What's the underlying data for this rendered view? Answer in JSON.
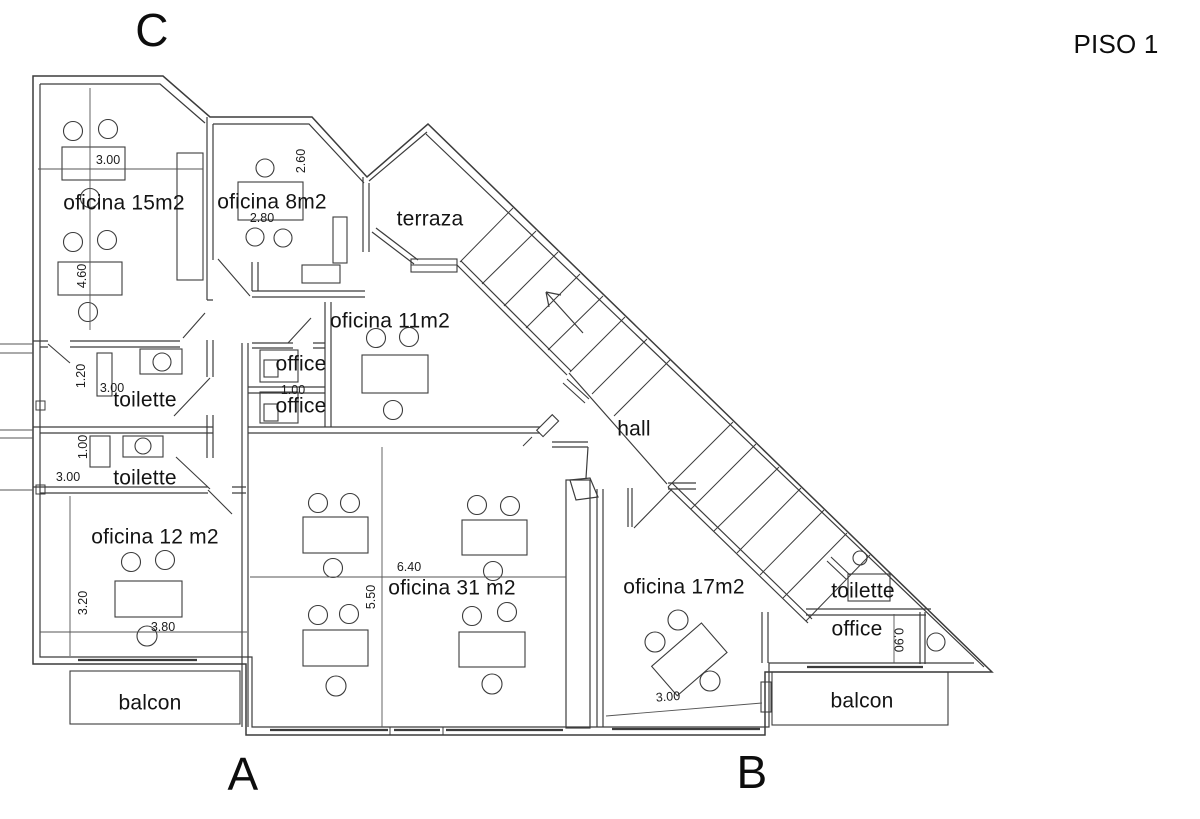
{
  "title": "PISO 1",
  "markers": {
    "top_left": "C",
    "bottom_left": "A",
    "bottom_right": "B"
  },
  "rooms": {
    "oficina15": "oficina 15m2",
    "oficina8": "oficina 8m2",
    "terraza": "terraza",
    "oficina11": "oficina 11m2",
    "office_upper": "office",
    "office_lower": "office",
    "toilette_upper": "toilette",
    "toilette_lower": "toilette",
    "hall": "hall",
    "oficina12": "oficina 12 m2",
    "oficina31": "oficina  31 m2",
    "oficina17": "oficina 17m2",
    "toilette_right": "toilette",
    "office_right": "office",
    "balcon_left": "balcon",
    "balcon_right": "balcon"
  },
  "dimensions": {
    "oficina15_width": "3.00",
    "oficina15_height": "4.60",
    "oficina8_height": "2.60",
    "oficina8_width": "2.80",
    "toilette_upper_height": "1.20",
    "toilette_upper_width": "3.00",
    "toilette_lower_height": "1.00",
    "toilette_lower_width": "3.00",
    "office_height": "1.00",
    "oficina31_width": "6.40",
    "oficina31_height": "5.50",
    "oficina12_height": "3.20",
    "oficina12_width": "3.80",
    "oficina17_width": "3.00",
    "office_right_height": "0.90"
  }
}
